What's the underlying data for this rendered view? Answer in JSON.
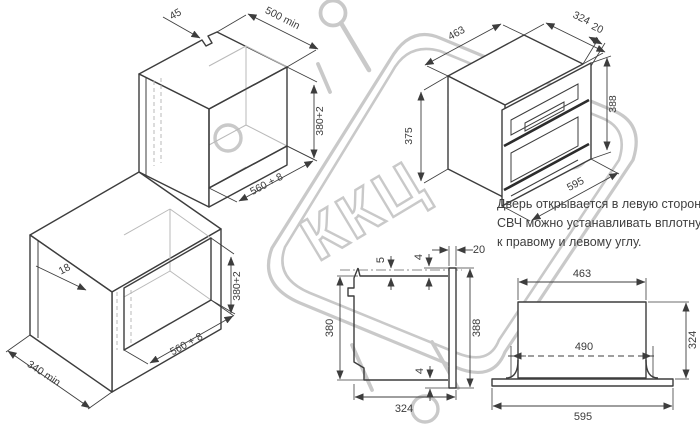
{
  "watermark": {
    "text": "ККЦ"
  },
  "note": {
    "line1": "Дверь открывается в левую сторону.",
    "line2": "СВЧ можно устанавливать вплотную",
    "line3": "к правому и левому углу."
  },
  "dims": {
    "tall_cabinet": {
      "top_notch": "45",
      "depth_min": "500 min",
      "niche_height": "380+2",
      "niche_width": "560 + 8"
    },
    "base_cabinet": {
      "panel_thickness": "18",
      "niche_height": "380+2",
      "niche_width": "560 + 8",
      "depth_min": "340 min"
    },
    "oven": {
      "body_width": "463",
      "body_depth": "324",
      "frame_depth": "20",
      "front_height": "388",
      "body_height": "375",
      "front_width": "595"
    },
    "side_view": {
      "top_gap": "5",
      "top_recess": "4",
      "frame_depth": "20",
      "body_height": "380",
      "front_height": "388",
      "bottom_recess": "4",
      "body_depth": "324"
    },
    "plan_view": {
      "body_width": "463",
      "cutout_width": "490",
      "body_depth": "324",
      "front_width": "595"
    }
  }
}
